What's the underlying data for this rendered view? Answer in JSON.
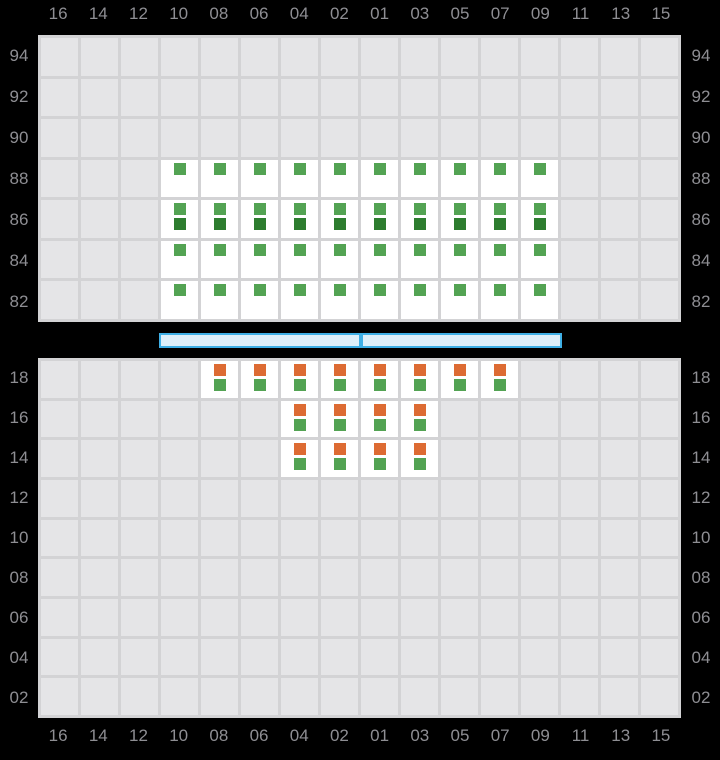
{
  "columns": [
    "16",
    "14",
    "12",
    "10",
    "08",
    "06",
    "04",
    "02",
    "01",
    "03",
    "05",
    "07",
    "09",
    "11",
    "13",
    "15"
  ],
  "upper_chart": {
    "row_labels": [
      "94",
      "92",
      "90",
      "88",
      "86",
      "84",
      "82"
    ],
    "rows": [
      {
        "row": "88",
        "columns": [
          "10",
          "08",
          "06",
          "04",
          "02",
          "01",
          "03",
          "05",
          "07",
          "09"
        ],
        "markers": [
          "green"
        ]
      },
      {
        "row": "86",
        "columns": [
          "10",
          "08",
          "06",
          "04",
          "02",
          "01",
          "03",
          "05",
          "07",
          "09"
        ],
        "markers": [
          "green",
          "dark_green"
        ]
      },
      {
        "row": "84",
        "columns": [
          "10",
          "08",
          "06",
          "04",
          "02",
          "01",
          "03",
          "05",
          "07",
          "09"
        ],
        "markers": [
          "green"
        ]
      },
      {
        "row": "82",
        "columns": [
          "10",
          "08",
          "06",
          "04",
          "02",
          "01",
          "03",
          "05",
          "07",
          "09"
        ],
        "markers": [
          "green"
        ]
      }
    ]
  },
  "lower_chart": {
    "row_labels": [
      "18",
      "16",
      "14",
      "12",
      "10",
      "08",
      "06",
      "04",
      "02"
    ],
    "rows": [
      {
        "row": "18",
        "columns": [
          "08",
          "06",
          "04",
          "02",
          "01",
          "03",
          "05",
          "07"
        ],
        "markers": [
          "orange",
          "green"
        ]
      },
      {
        "row": "16",
        "columns": [
          "04",
          "02",
          "01",
          "03"
        ],
        "markers": [
          "orange",
          "green"
        ]
      },
      {
        "row": "14",
        "columns": [
          "04",
          "02",
          "01",
          "03"
        ],
        "markers": [
          "orange",
          "green"
        ]
      }
    ]
  },
  "divider": {
    "segment_count": 2
  },
  "colors": {
    "green": "#53a353",
    "dark_green": "#2d7d2f",
    "orange": "#dd6b33",
    "bar_fill": "#def0fa",
    "bar_border": "#3fb0e6",
    "grid_cell": "#e5e5e7",
    "grid_line": "#d3d3d5",
    "label": "#8e8e93",
    "seat_bg": "#ffffff",
    "background": "#000000"
  }
}
